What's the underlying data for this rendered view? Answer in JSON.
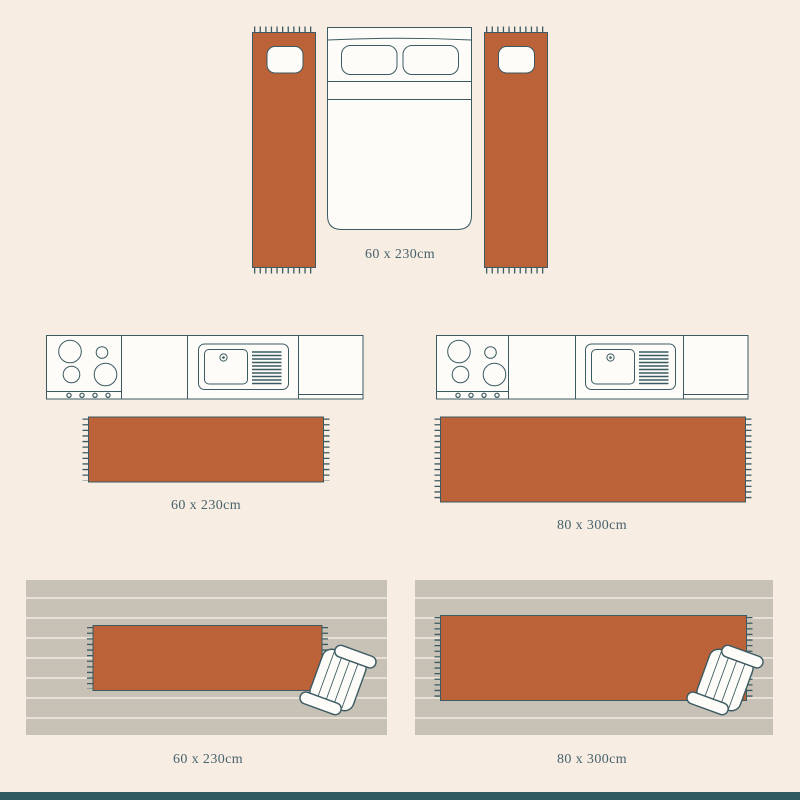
{
  "colors": {
    "background": "#f8ede3",
    "rug": "#bc6238",
    "outline": "#3b5a62",
    "white": "#fdfcf8",
    "floor": "#c8c2b6",
    "floor_line": "#f0eae0",
    "label": "#47636c",
    "footer": "#2e5a60"
  },
  "scenes": {
    "bedroom": {
      "illustration": "bed-with-bedside-runner-rugs-top-view",
      "size_label": "60 x 230cm"
    },
    "kitchen_small": {
      "illustration": "kitchen-counter-with-runner-rug-top-view",
      "size_label": "60 x 230cm"
    },
    "kitchen_large": {
      "illustration": "kitchen-counter-with-runner-rug-top-view",
      "size_label": "80 x 300cm"
    },
    "hallway_small": {
      "illustration": "wood-floor-runner-rug-with-bench-top-view",
      "size_label": "60 x 230cm"
    },
    "hallway_large": {
      "illustration": "wood-floor-runner-rug-with-bench-top-view",
      "size_label": "80 x 300cm"
    }
  }
}
